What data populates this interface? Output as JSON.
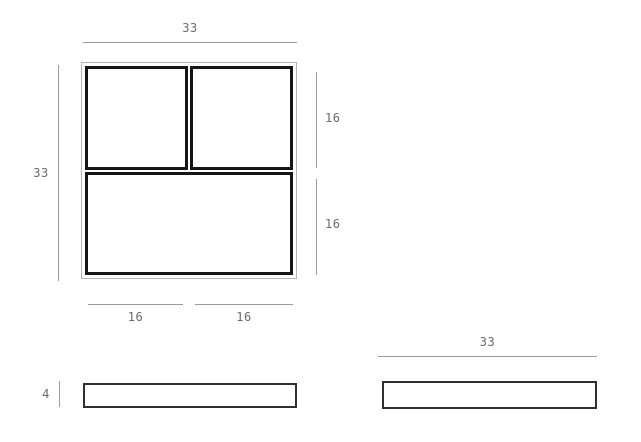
{
  "colors": {
    "background": "#ffffff",
    "dimension_line": "#9b9b9b",
    "dimension_text": "#6a6a6a",
    "unit_outline": "#161616",
    "unit_frame": "#b4b4b4",
    "panel_outline": "#2f2f2f"
  },
  "front_view": {
    "overall_width": "33",
    "overall_height": "33",
    "top_row_height": "16",
    "bottom_row_height": "16",
    "left_column_width": "16",
    "right_column_width": "16"
  },
  "side_view": {
    "panel_thickness": "4"
  },
  "top_view": {
    "panel_width": "33"
  }
}
